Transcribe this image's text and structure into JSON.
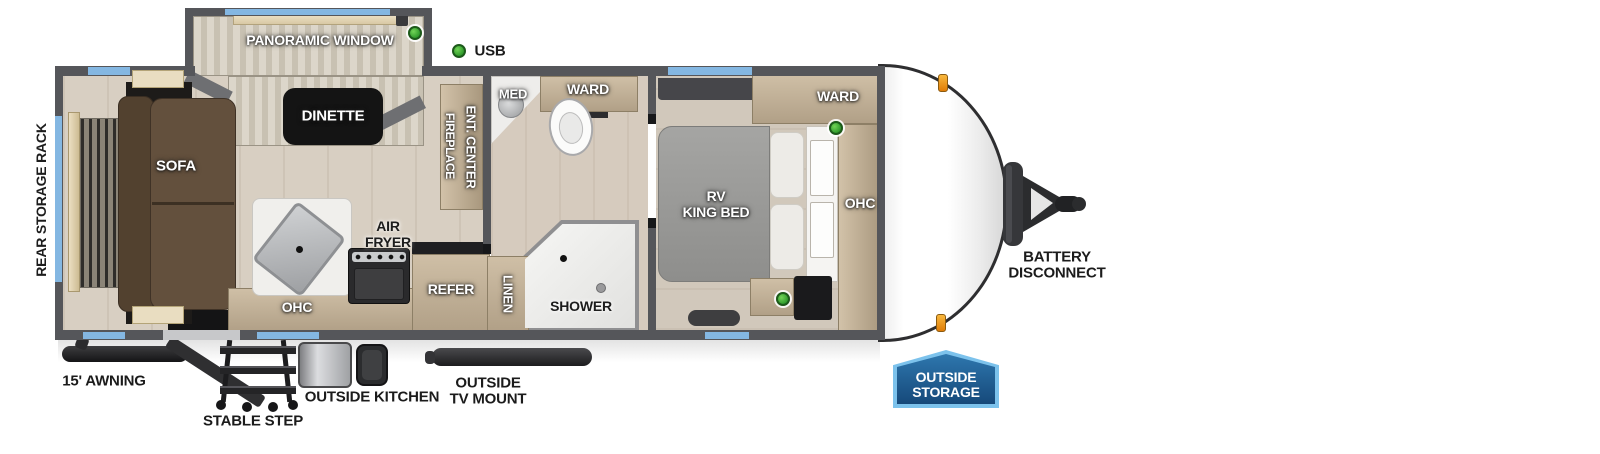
{
  "colors": {
    "wall_gray": "#55565a",
    "window_blue": "#84b7e2",
    "usb_green": "#3fae3a",
    "marker_orange": "#f0961e",
    "badge_fill": "#1c5c95",
    "badge_border": "#7cc2ec"
  },
  "legend": {
    "usb": "USB"
  },
  "exterior": {
    "rear_storage_rack": "REAR STORAGE RACK",
    "awning": "15' AWNING",
    "stable_step": "STABLE STEP",
    "outside_kitchen": "OUTSIDE KITCHEN",
    "outside_tv_mount": [
      "OUTSIDE",
      "TV MOUNT"
    ],
    "battery_disconnect": [
      "BATTERY",
      "DISCONNECT"
    ],
    "outside_storage": [
      "OUTSIDE",
      "STORAGE"
    ]
  },
  "rooms": {
    "living": {
      "sofa": "SOFA",
      "dinette": "DINETTE",
      "panoramic_window": "PANORAMIC WINDOW",
      "fireplace": "FIREPLACE",
      "ent_center": "ENT. CENTER"
    },
    "kitchen": {
      "air_fryer": [
        "AIR",
        "FRYER"
      ],
      "ohc": "OHC",
      "refer": "REFER"
    },
    "bath": {
      "med": "MED",
      "ward": "WARD",
      "linen": "LINEN",
      "shower": "SHOWER"
    },
    "bedroom": {
      "bed": [
        "RV",
        "KING BED"
      ],
      "ward": "WARD",
      "ohc": "OHC"
    }
  }
}
